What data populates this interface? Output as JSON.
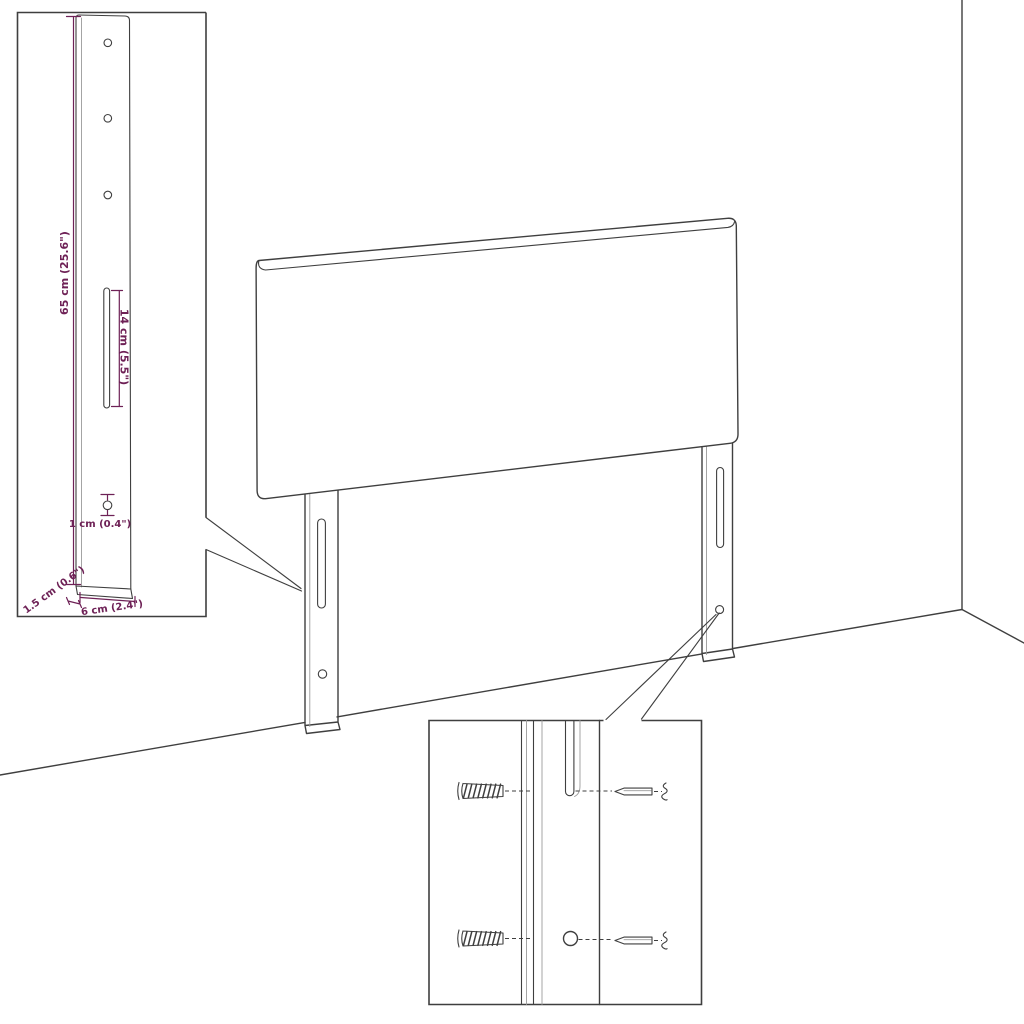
{
  "colors": {
    "background": "#ffffff",
    "line": "#3f3f3f",
    "line_light": "#9b9b9b",
    "dimension": "#6e2156"
  },
  "dims": {
    "bracket_height": "65 cm (25.6\")",
    "slot_length": "14 cm (5.5\")",
    "hole_diameter": "1 cm (0.4\")",
    "bracket_depth": "1.5 cm (0.6\")",
    "bracket_width": "6 cm (2.4\")"
  },
  "mounting_detail": {
    "wall_plug_count": 2,
    "screw_count": 2,
    "slot_count": 1,
    "hole_count": 1
  }
}
